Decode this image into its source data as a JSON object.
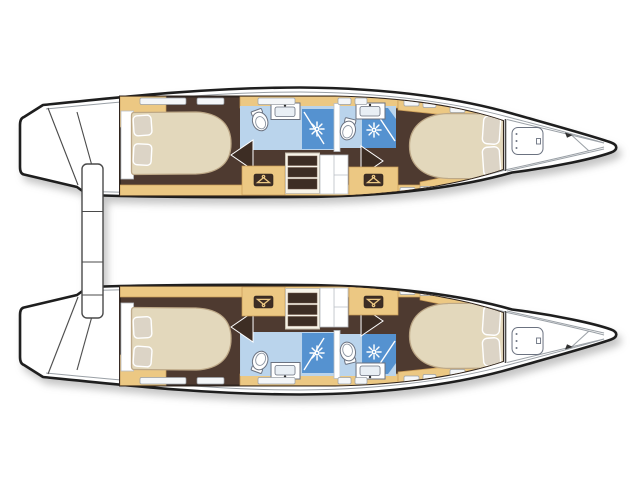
{
  "diagram": {
    "title": "Catamaran lower-deck layout plan (top view, bow to the right)",
    "type": "boat-floor-plan",
    "hull_count": 2,
    "cabin_count": 4,
    "head_count": 4,
    "hulls": [
      {
        "id": "port",
        "position": "top",
        "rooms": [
          "aft double cabin",
          "aft head with shower",
          "wardrobe",
          "companionway steps",
          "forward head with shower",
          "wardrobe",
          "forward double cabin",
          "bow deck with hatch"
        ]
      },
      {
        "id": "starboard",
        "position": "bottom",
        "rooms": [
          "aft double cabin",
          "aft head with shower",
          "wardrobe",
          "companionway steps",
          "forward head with shower",
          "wardrobe",
          "forward double cabin",
          "bow deck with hatch"
        ]
      }
    ],
    "stern_feature": "transom sugar-scoop steps with center platform",
    "icons": {
      "sunburst": "shower spray",
      "hanger": "wardrobe locker",
      "oval": "toilet",
      "small-basin": "washbasin",
      "rounded-rectangle": "deck hatch"
    }
  },
  "colors": {
    "outline": "#1e1e1e",
    "deckWhite": "#ffffff",
    "deckLine": "#9aa0a6",
    "woodTan": "#ecc883",
    "woodTanDark": "#c89a56",
    "floorBrown": "#4e3a30",
    "floorBrownDark": "#3d2d24",
    "bedCream": "#e3d8bc",
    "bedShadow": "#bda887",
    "pillow": "#dcd4c6",
    "bathBlueLight": "#bad4ec",
    "showerBlue": "#5592d0",
    "fixtureWhite": "#ffffff",
    "fixtureOutline": "#6b7280",
    "interiorBorder": "#2f241e",
    "windowFill": "#f4f6f8"
  }
}
